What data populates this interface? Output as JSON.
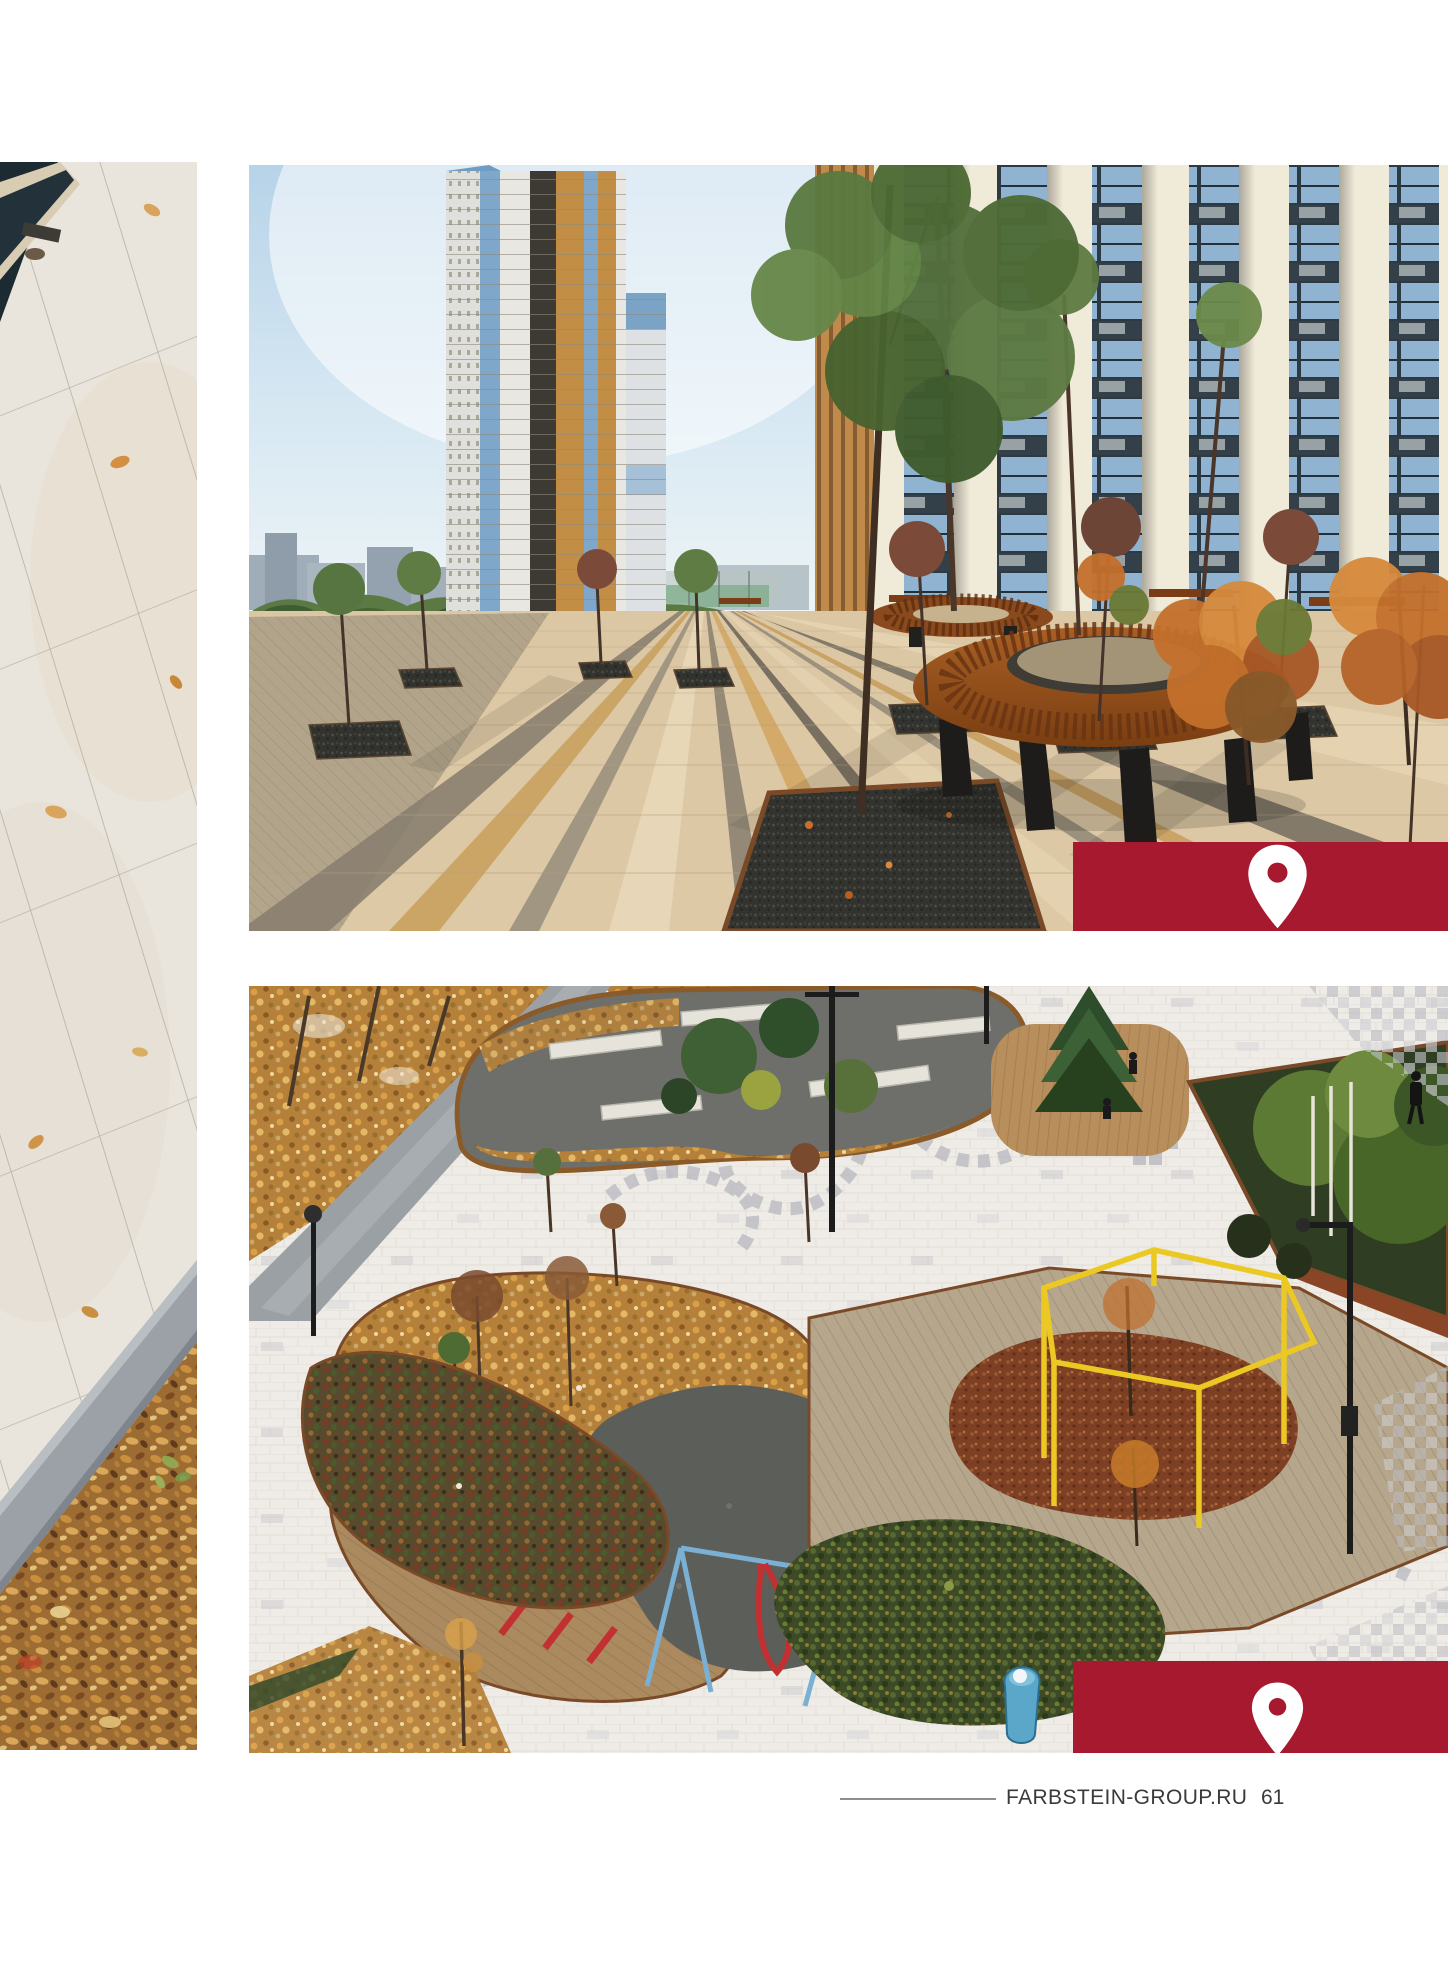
{
  "page": {
    "background_color": "#ffffff",
    "accent_red": "#A6192E",
    "caption_text_color": "#ffffff",
    "footer_text_color": "#3a3a39"
  },
  "captions": {
    "ufa": {
      "icon": "location-pin-icon",
      "text": "Уфа. ЖК «Умный дом»"
    },
    "kazan": {
      "icon": "location-pin-icon",
      "line1": "Казань.",
      "line2": "Бульвар «Белые цветы»"
    }
  },
  "footer": {
    "website": "FARBSTEIN-GROUP.RU",
    "page_number": "61"
  }
}
